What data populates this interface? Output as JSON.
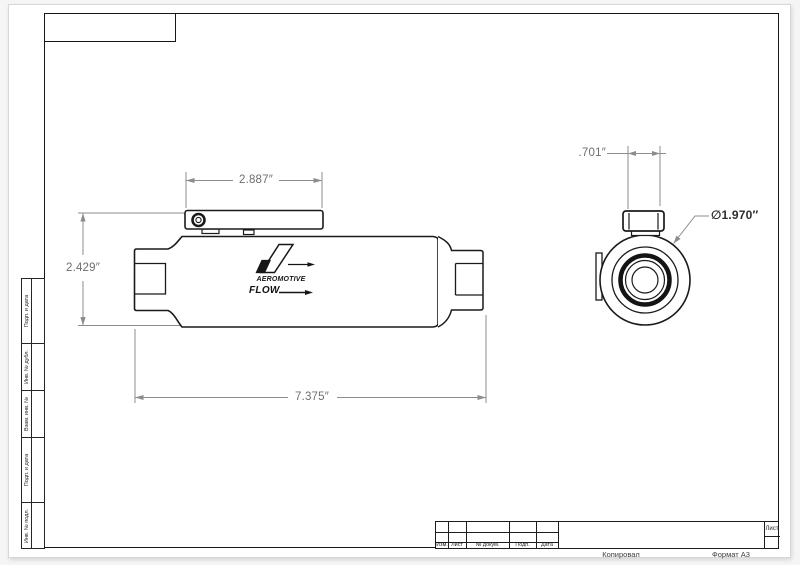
{
  "frame_stamps": {
    "vertical_labels": [
      "Подп. и дата",
      "Инв. № дубл.",
      "Взам. инв. №",
      "Подп. и дата",
      "Инв. № подл."
    ]
  },
  "title_block": {
    "columns": [
      "Изм.",
      "Лист",
      "№ докум.",
      "Подп.",
      "Дата"
    ],
    "sheet_label": "Лист",
    "copied_label": "Копировал",
    "format_label": "Формат А3"
  },
  "drawing": {
    "brand": "AEROMOTIVE",
    "flow_label": "FLOW",
    "dimensions": {
      "bracket_width": "2.887″",
      "overall_height": "2.429″",
      "overall_length": "7.375″",
      "port_width": ".701″",
      "body_diameter": "∅1.970″"
    }
  }
}
